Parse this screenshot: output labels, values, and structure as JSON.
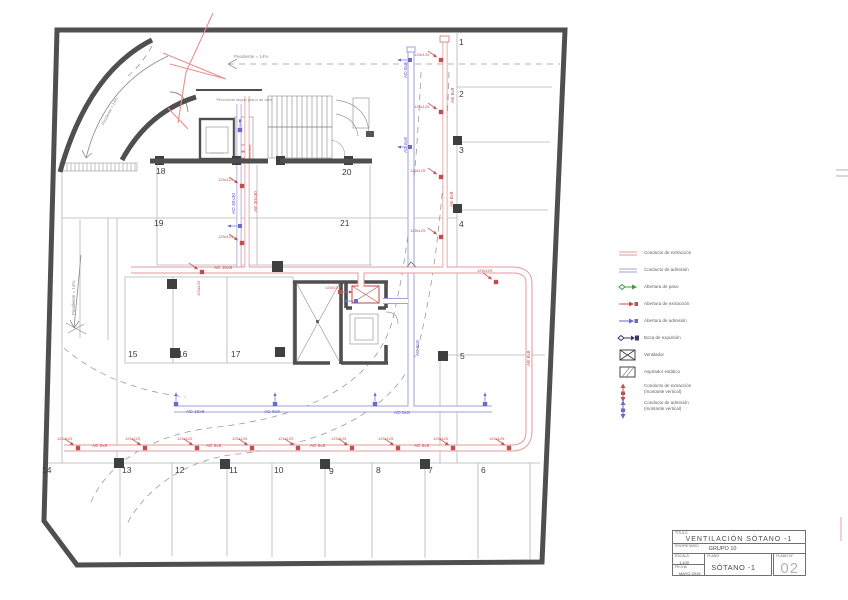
{
  "colors": {
    "wall": "#4f4f4f",
    "thin": "#a9a9a9",
    "extraction_red": "#e49a9a",
    "admission_blue": "#a2a2da",
    "grille_red": "#c05050",
    "grille_blue": "#6a6ac8",
    "revision": "#e88f8f",
    "paso_green": "#3f9e3f"
  },
  "plan": {
    "parking_numbers": [
      {
        "n": "1",
        "x": 459,
        "y": 38
      },
      {
        "n": "2",
        "x": 459,
        "y": 90
      },
      {
        "n": "3",
        "x": 459,
        "y": 146
      },
      {
        "n": "4",
        "x": 459,
        "y": 220
      },
      {
        "n": "5",
        "x": 460,
        "y": 352
      },
      {
        "n": "6",
        "x": 481,
        "y": 466
      },
      {
        "n": "7",
        "x": 428,
        "y": 466
      },
      {
        "n": "8",
        "x": 376,
        "y": 466
      },
      {
        "n": "9",
        "x": 329,
        "y": 467
      },
      {
        "n": "10",
        "x": 274,
        "y": 466
      },
      {
        "n": "11",
        "x": 229,
        "y": 466
      },
      {
        "n": "12",
        "x": 175,
        "y": 466
      },
      {
        "n": "13",
        "x": 122,
        "y": 466
      },
      {
        "n": "14",
        "x": 42,
        "y": 466
      },
      {
        "n": "15",
        "x": 128,
        "y": 350
      },
      {
        "n": "16",
        "x": 178,
        "y": 350
      },
      {
        "n": "17",
        "x": 231,
        "y": 350
      },
      {
        "n": "18",
        "x": 156,
        "y": 167
      },
      {
        "n": "19",
        "x": 154,
        "y": 219
      },
      {
        "n": "20",
        "x": 342,
        "y": 168
      },
      {
        "n": "21",
        "x": 340,
        "y": 219
      }
    ],
    "duct_labels": [
      {
        "t": "AE 8x8",
        "x": 92,
        "y": 445,
        "cls": "dl r"
      },
      {
        "t": "AE 8x8",
        "x": 206,
        "y": 445,
        "cls": "dl r"
      },
      {
        "t": "AE 8x8",
        "x": 310,
        "y": 445,
        "cls": "dl r"
      },
      {
        "t": "AE 8x8",
        "x": 414,
        "y": 445,
        "cls": "dl r"
      },
      {
        "t": "AE 10x8",
        "x": 214,
        "y": 267,
        "cls": "dl r"
      },
      {
        "t": "AE 8x8",
        "x": 452,
        "y": 103,
        "r": -90,
        "cls": "dl r"
      },
      {
        "t": "AE 8x8",
        "x": 451,
        "y": 207,
        "r": -90,
        "cls": "dl r"
      },
      {
        "t": "AE 8x8",
        "x": 528,
        "y": 366,
        "r": -90,
        "cls": "dl r"
      },
      {
        "t": "AE 30x30",
        "x": 255,
        "y": 212,
        "r": -90,
        "cls": "dl r"
      },
      {
        "t": "AD 10x8",
        "x": 186,
        "y": 411,
        "cls": "dl b"
      },
      {
        "t": "AD 8x8",
        "x": 264,
        "y": 411,
        "cls": "dl b"
      },
      {
        "t": "AD 8x8",
        "x": 394,
        "y": 412,
        "cls": "dl b"
      },
      {
        "t": "AD 8x8",
        "x": 405,
        "y": 78,
        "r": -90,
        "cls": "dl b"
      },
      {
        "t": "AD 8x8",
        "x": 405,
        "y": 153,
        "r": -90,
        "cls": "dl b"
      },
      {
        "t": "AD 8x8",
        "x": 417,
        "y": 356,
        "r": -90,
        "cls": "dl b"
      },
      {
        "t": "AD 30x30",
        "x": 233,
        "y": 214,
        "r": -90,
        "cls": "dl b"
      },
      {
        "t": "125x125",
        "x": 57,
        "y": 437,
        "cls": "tn r"
      },
      {
        "t": "125x125",
        "x": 125,
        "y": 437,
        "cls": "tn r"
      },
      {
        "t": "125x125",
        "x": 177,
        "y": 437,
        "cls": "tn r"
      },
      {
        "t": "125x125",
        "x": 232,
        "y": 437,
        "cls": "tn r"
      },
      {
        "t": "125x125",
        "x": 278,
        "y": 437,
        "cls": "tn r"
      },
      {
        "t": "125x125",
        "x": 331,
        "y": 437,
        "cls": "tn r"
      },
      {
        "t": "125x125",
        "x": 378,
        "y": 437,
        "cls": "tn r"
      },
      {
        "t": "125x125",
        "x": 433,
        "y": 437,
        "cls": "tn r"
      },
      {
        "t": "125x125",
        "x": 489,
        "y": 437,
        "cls": "tn r"
      },
      {
        "t": "125x125",
        "x": 414,
        "y": 53,
        "cls": "tn r"
      },
      {
        "t": "125x125",
        "x": 414,
        "y": 105,
        "cls": "tn r"
      },
      {
        "t": "125x125",
        "x": 410,
        "y": 169,
        "cls": "tn r"
      },
      {
        "t": "125x125",
        "x": 410,
        "y": 229,
        "cls": "tn r"
      },
      {
        "t": "125x125",
        "x": 218,
        "y": 178,
        "cls": "tn r"
      },
      {
        "t": "125x125",
        "x": 218,
        "y": 235,
        "cls": "tn r"
      },
      {
        "t": "125x125",
        "x": 477,
        "y": 269,
        "cls": "tn r"
      },
      {
        "t": "125x125",
        "x": 325,
        "y": 286,
        "cls": "tn r"
      },
      {
        "t": "125x125",
        "x": 197,
        "y": 296,
        "r": -90,
        "cls": "tn r"
      }
    ],
    "annotations": [
      {
        "t": "Pendiente = 14%",
        "x": 234,
        "y": 55,
        "cls": "ann"
      },
      {
        "t": "Pendiente = 14%",
        "x": 72,
        "y": 315,
        "r": -90,
        "cls": "ann"
      },
      {
        "t": "Pendiente = 14%",
        "x": 101,
        "y": 124,
        "r": -62,
        "cls": "tn g"
      },
      {
        "t": "*Recorrido según plano de obra",
        "x": 216,
        "y": 98,
        "cls": "tn g"
      }
    ]
  },
  "legend": {
    "items": [
      {
        "type": "duct-red",
        "label": "Conducto de extracción"
      },
      {
        "type": "duct-blue",
        "label": "Conducto de admisión"
      },
      {
        "type": "paso",
        "label": "Abertura de paso"
      },
      {
        "type": "ab-red",
        "label": "Abertura de extracción"
      },
      {
        "type": "ab-blue",
        "label": "Abertura de admisión"
      },
      {
        "type": "boca",
        "label": "Boca de expulsión"
      },
      {
        "type": "ventilador",
        "label": "Ventilador"
      },
      {
        "type": "aspirador",
        "label": "Aspirador estático"
      },
      {
        "type": "mont-red",
        "label": "Conducto de extracción",
        "label2": "(montante vertical)"
      },
      {
        "type": "mont-blue",
        "label": "Conducto de admisión",
        "label2": "(montante vertical)"
      }
    ]
  },
  "title_block": {
    "titulo_label": "TÍTULO",
    "titulo": "VENTILACIÓN SÓTANO -1",
    "propietario_label": "PROPIETARIO",
    "propietario": "GRUPO 10",
    "escala_label": "ESCALA",
    "escala": "1:100",
    "fecha_label": "FECHA",
    "fecha": "MAYO 2019",
    "plano_label": "PLANO",
    "plano": "SÓTANO -1",
    "numero_label": "PLANO Nº",
    "numero": "02"
  }
}
